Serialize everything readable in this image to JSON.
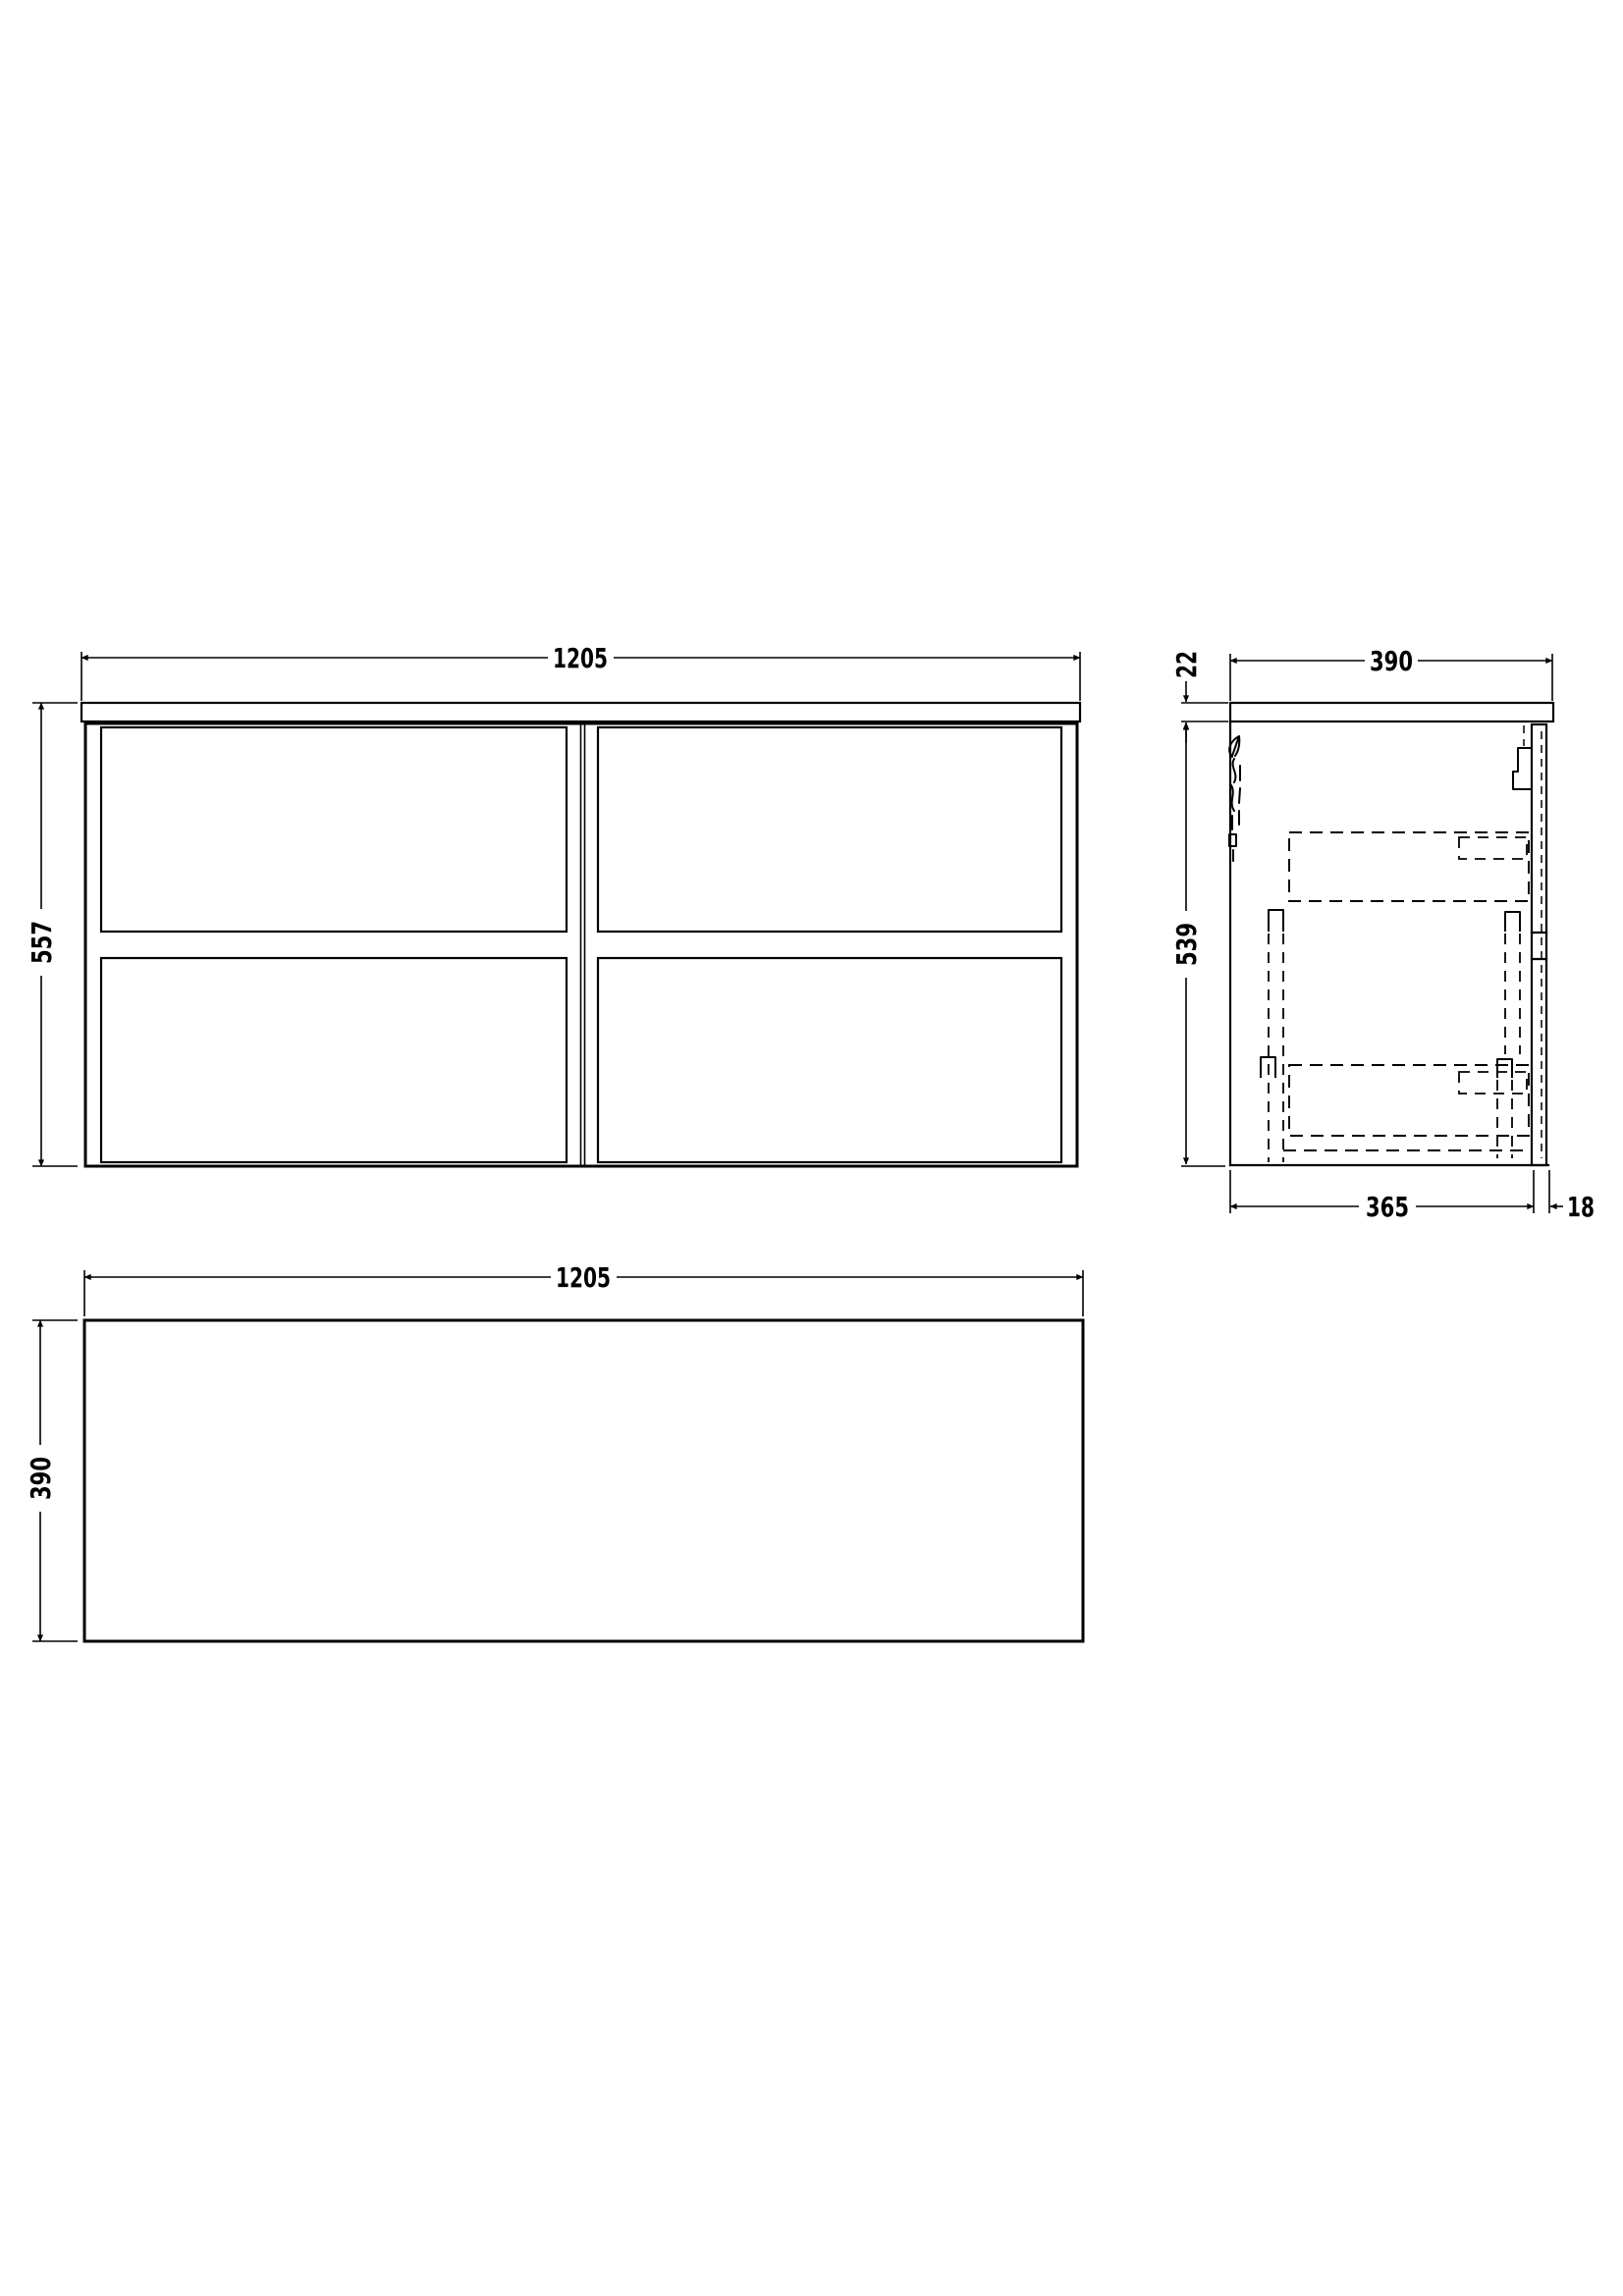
{
  "document": {
    "type": "furniture-technical-drawing",
    "background_color": "#ffffff",
    "line_color": "#000000"
  },
  "views": {
    "front": {
      "width_label": "1205",
      "height_label": "557"
    },
    "side": {
      "countertop_thickness_label": "22",
      "depth_label": "390",
      "height_label": "539",
      "body_depth_label": "365",
      "front_panel_thickness_label": "18"
    },
    "plan": {
      "width_label": "1205",
      "depth_label": "390"
    }
  }
}
